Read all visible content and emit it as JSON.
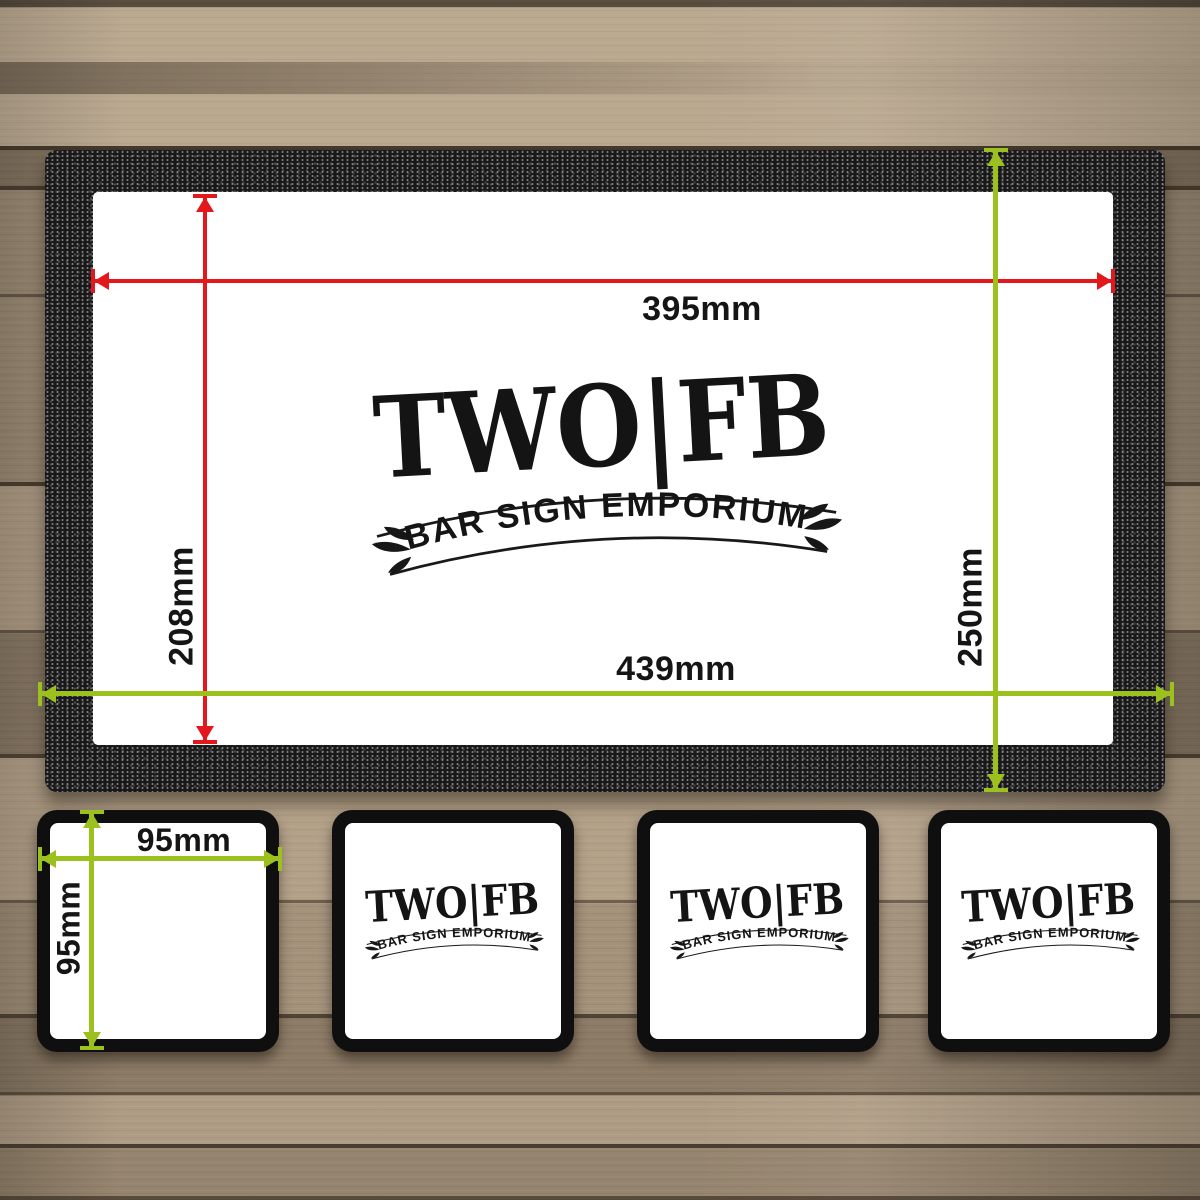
{
  "logo": {
    "title": "TWO|FB",
    "subtitle": "BAR SIGN EMPORIUM"
  },
  "measurements": {
    "print_width": "395mm",
    "print_height": "208mm",
    "mat_width": "439mm",
    "mat_height": "250mm",
    "coaster_width": "95mm",
    "coaster_height": "95mm"
  },
  "colors": {
    "dimension_red": "#e2181d",
    "dimension_green": "#9cc11e",
    "mat_black": "#181818",
    "coaster_black": "#0f0f0f",
    "print_white": "#ffffff",
    "wood_base": "#a5937c"
  },
  "icons": {
    "flourish": "leaf-flourish",
    "dimension_arrow": "double-headed-arrow"
  }
}
